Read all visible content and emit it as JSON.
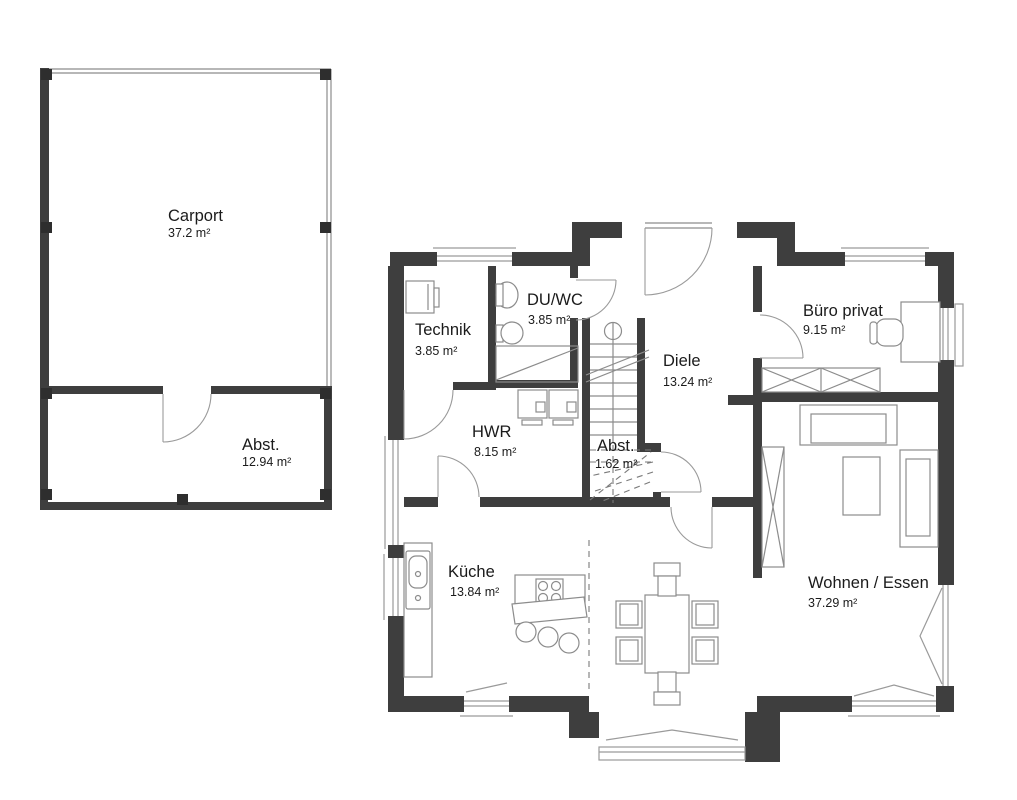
{
  "plan": {
    "carport": {
      "name": "Carport",
      "area": "37.2 m²"
    },
    "carport_abst": {
      "name": "Abst.",
      "area": "12.94 m²"
    },
    "technik": {
      "name": "Technik",
      "area": "3.85 m²"
    },
    "duwc": {
      "name": "DU/WC",
      "area": "3.85 m²"
    },
    "diele": {
      "name": "Diele",
      "area": "13.24 m²"
    },
    "buero": {
      "name": "Büro privat",
      "area": "9.15 m²"
    },
    "hwr": {
      "name": "HWR",
      "area": "8.15 m²"
    },
    "abst_stairs": {
      "name": "Abst.",
      "area": "1.62 m²"
    },
    "kueche": {
      "name": "Küche",
      "area": "13.84 m²"
    },
    "wohnen": {
      "name": "Wohnen / Essen",
      "area": "37.29 m²"
    },
    "colors": {
      "wall": "#3e3e3e",
      "post": "#2e2e2e",
      "furniture_line": "#8c8c8c",
      "door_arc": "#9a9a9a",
      "text": "#1b1b1b",
      "background": "#ffffff"
    }
  }
}
